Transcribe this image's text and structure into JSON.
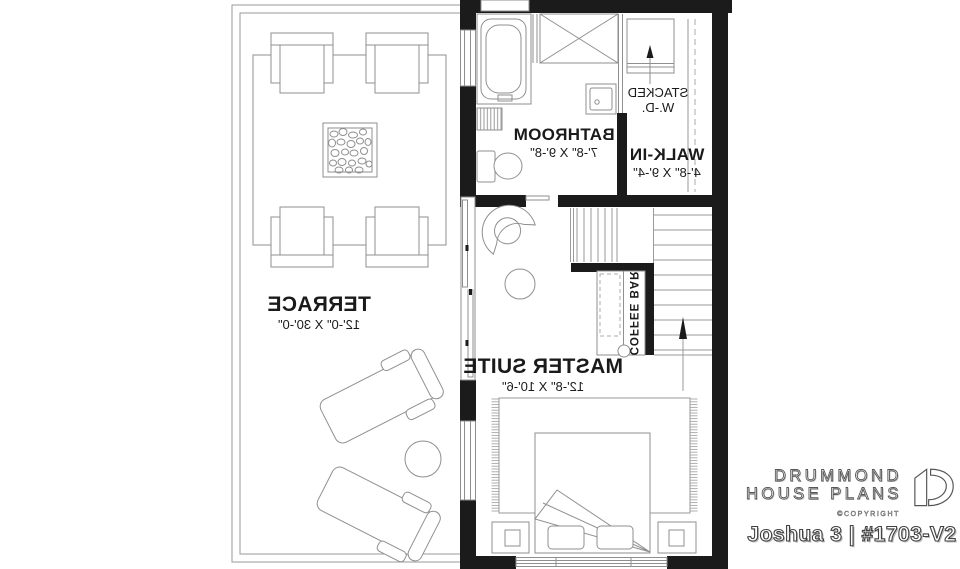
{
  "plan": {
    "rooms": {
      "terrace": {
        "name": "TERRACE",
        "dim": "12'-0\" X 30'-0\""
      },
      "bathroom": {
        "name": "BATHROOM",
        "dim": "7'-8\" X 9'-8\""
      },
      "walkin": {
        "name": "WALK-IN",
        "dim": "4'-8\" X 9'-4\""
      },
      "master": {
        "name": "MASTER SUITE",
        "dim": "12'-8\" X 10'-6\""
      }
    },
    "features": {
      "stacked_wd_line1": "STACKED",
      "stacked_wd_line2": "W.-D.",
      "coffee_bar": "COFFEE BAR"
    }
  },
  "branding": {
    "name_line1": "DRUMMOND",
    "name_line2": "HOUSE PLANS",
    "copyright": "©COPYRIGHT",
    "plan_id": "Joshua 3 | #1703-V2"
  },
  "colors": {
    "wall": "#1b1b1b",
    "furniture_line": "#8f8f8f",
    "label_text": "#1a1a1a",
    "logo_fill": "#ffffff",
    "logo_outline": "#565656"
  }
}
